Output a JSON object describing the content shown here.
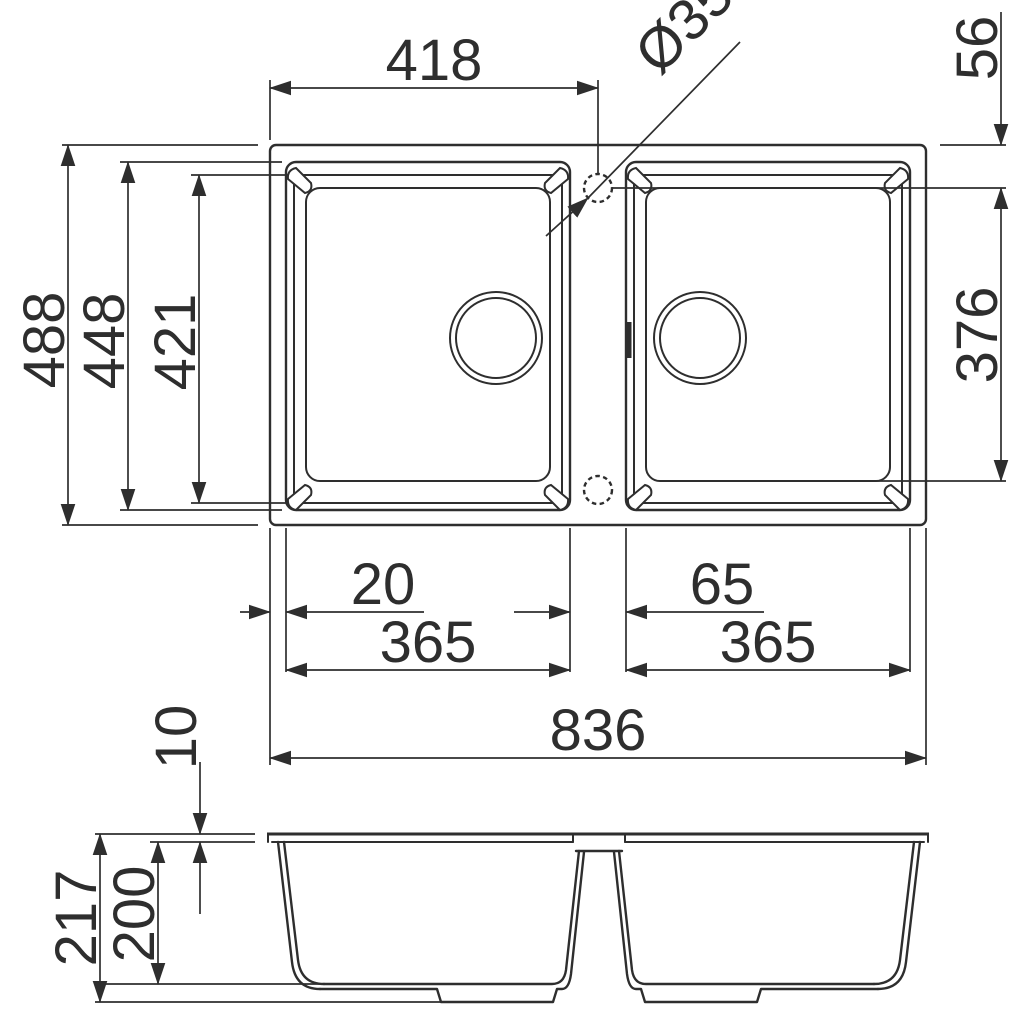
{
  "drawing": {
    "title": "Double-bowl kitchen sink dimension drawing",
    "views": {
      "plan": "top view",
      "section": "front section view"
    },
    "line_color": "#2e2e2e",
    "background_color": "#ffffff"
  },
  "dims": {
    "edge_to_hole_width": "418",
    "hole_diameter": "Ø35",
    "hole_from_edge": "56",
    "overall_depth": "488",
    "rim_outer_depth": "448",
    "bowl_depth": "421",
    "bowl_inner_depth": "376",
    "edge_to_bowl": "20",
    "between_bowls": "65",
    "left_bowl_width": "365",
    "right_bowl_width": "365",
    "overall_width": "836",
    "rim_thickness": "10",
    "overall_height": "217",
    "bowl_height": "200"
  }
}
